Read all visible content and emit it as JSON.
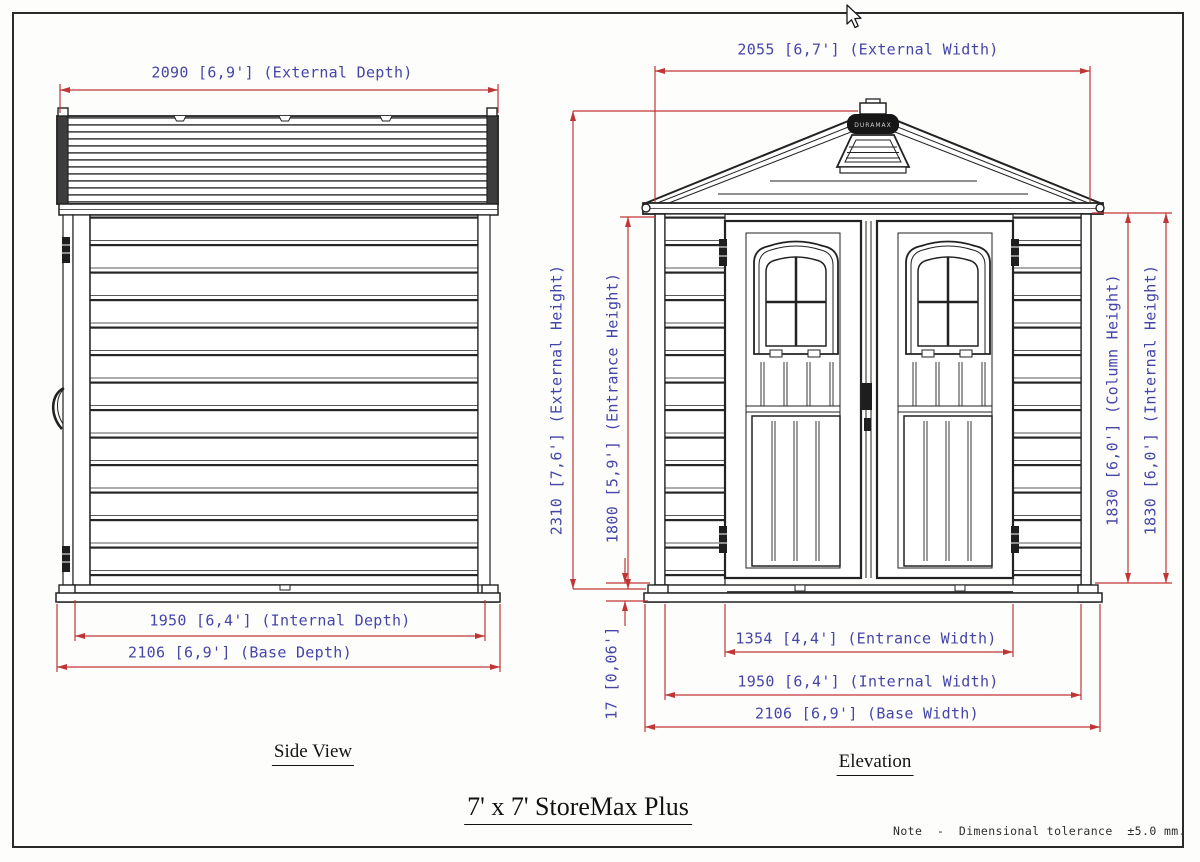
{
  "title": "7' x 7' StoreMax Plus",
  "note": "Note  -  Dimensional tolerance  ±5.0 mm.",
  "colors": {
    "dimension_line_red": "#c03636",
    "dimension_text_blue": "#4545a8",
    "drawing_line_black": "#222222"
  },
  "side_view": {
    "caption": "Side View",
    "dim_external_depth": "2090 [6,9'] (External Depth)",
    "dim_internal_depth": "1950 [6,4'] (Internal Depth)",
    "dim_base_depth": "2106 [6,9'] (Base Depth)"
  },
  "elevation": {
    "caption": "Elevation",
    "roof_brand": "DURAMAX",
    "dim_external_width": "2055 [6,7'] (External Width)",
    "dim_external_height": "2310 [7,6'] (External Height)",
    "dim_entrance_height": "1800 [5,9'] (Entrance Height)",
    "dim_column_height": "1830 [6,0'] (Column Height)",
    "dim_internal_height": "1830 [6,0'] (Internal Height)",
    "dim_entrance_width": "1354 [4,4'] (Entrance Width)",
    "dim_internal_width": "1950 [6,4'] (Internal Width)",
    "dim_base_width": "2106 [6,9'] (Base Width)",
    "dim_floor_height": "17 [0,06']"
  }
}
